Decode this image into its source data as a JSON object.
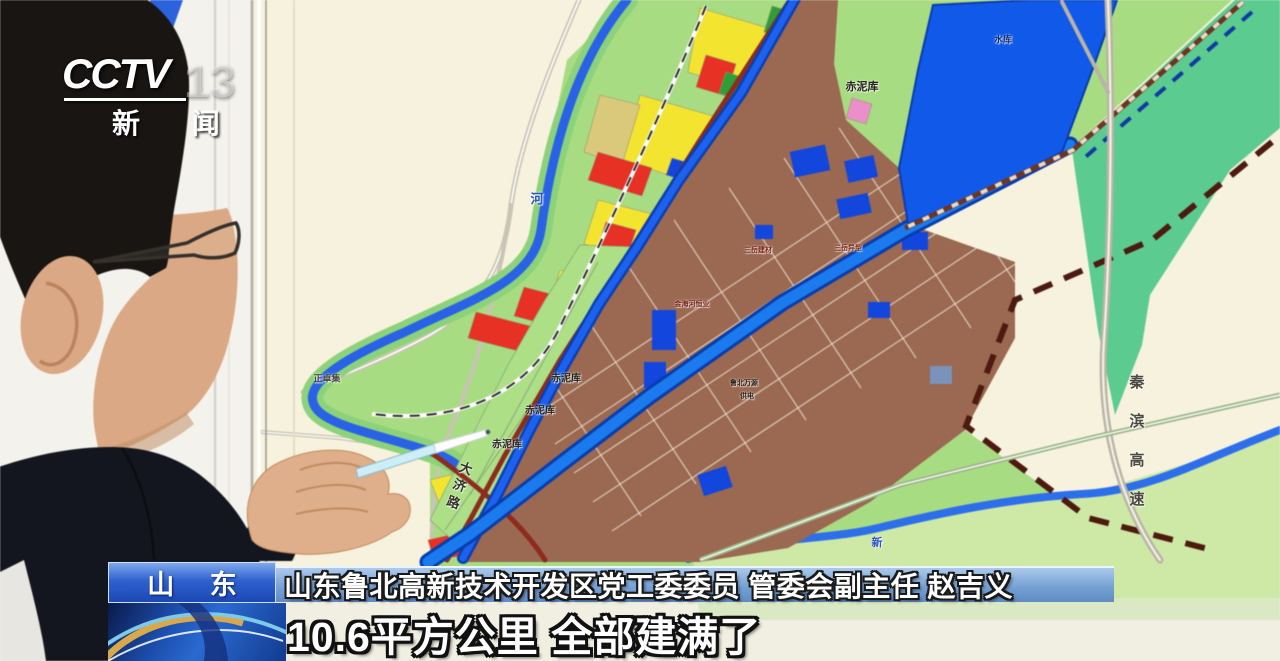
{
  "channel_bug": {
    "brand": "CCTV",
    "number": "13",
    "channel_name": "新 闻"
  },
  "lower_third": {
    "region_tag": "山 东",
    "speaker_title": "山东鲁北高新技术开发区党工委委员 管委会副主任 赵吉义",
    "caption": "10.6平方公里 全部建满了"
  },
  "map": {
    "colors": {
      "water_blue": "#1a5ae0",
      "terrain_green": "#a9db85",
      "valley_green": "#5fca90",
      "built_up_brown": "#996852",
      "residential_yellow": "#f2e437",
      "commercial_red": "#e03226",
      "board_cream": "#f7f2df"
    },
    "labels": [
      {
        "text": "赤泥库",
        "x": 862,
        "y": 86,
        "size": 11,
        "color": "#23231c"
      },
      {
        "text": "赤泥库",
        "x": 566,
        "y": 377,
        "size": 10,
        "color": "#23231c"
      },
      {
        "text": "赤泥库",
        "x": 540,
        "y": 409,
        "size": 10,
        "color": "#23231c"
      },
      {
        "text": "赤泥库",
        "x": 507,
        "y": 443,
        "size": 10,
        "color": "#23231c"
      },
      {
        "text": "水库",
        "x": 1003,
        "y": 39,
        "size": 9,
        "color": "#0d2f7a"
      },
      {
        "text": "河",
        "x": 537,
        "y": 198,
        "size": 13,
        "color": "#2b55c8"
      },
      {
        "text": "新",
        "x": 877,
        "y": 542,
        "size": 11,
        "color": "#2b55c8"
      },
      {
        "text": "正卓集",
        "x": 327,
        "y": 378,
        "size": 9,
        "color": "#4a463c"
      },
      {
        "text": "三岳建材",
        "x": 758,
        "y": 250,
        "size": 7,
        "color": "#7a2418"
      },
      {
        "text": "三岳异型",
        "x": 848,
        "y": 248,
        "size": 7,
        "color": "#7a2418"
      },
      {
        "text": "金海河恒业",
        "x": 692,
        "y": 304,
        "size": 7,
        "color": "#7a2418"
      },
      {
        "text": "鲁北万源",
        "x": 744,
        "y": 383,
        "size": 7,
        "color": "#2a2018"
      },
      {
        "text": "供电",
        "x": 747,
        "y": 396,
        "size": 7,
        "color": "#2a2018"
      },
      {
        "text": "大济路",
        "x": 458,
        "y": 487,
        "size": 13,
        "color": "#33302a",
        "vertical": true,
        "spacing": 5,
        "rotate": 20
      },
      {
        "text": "秦滨高速",
        "x": 1136,
        "y": 452,
        "size": 15,
        "color": "#4a4a40",
        "vertical": true,
        "spacing": 24
      }
    ]
  }
}
